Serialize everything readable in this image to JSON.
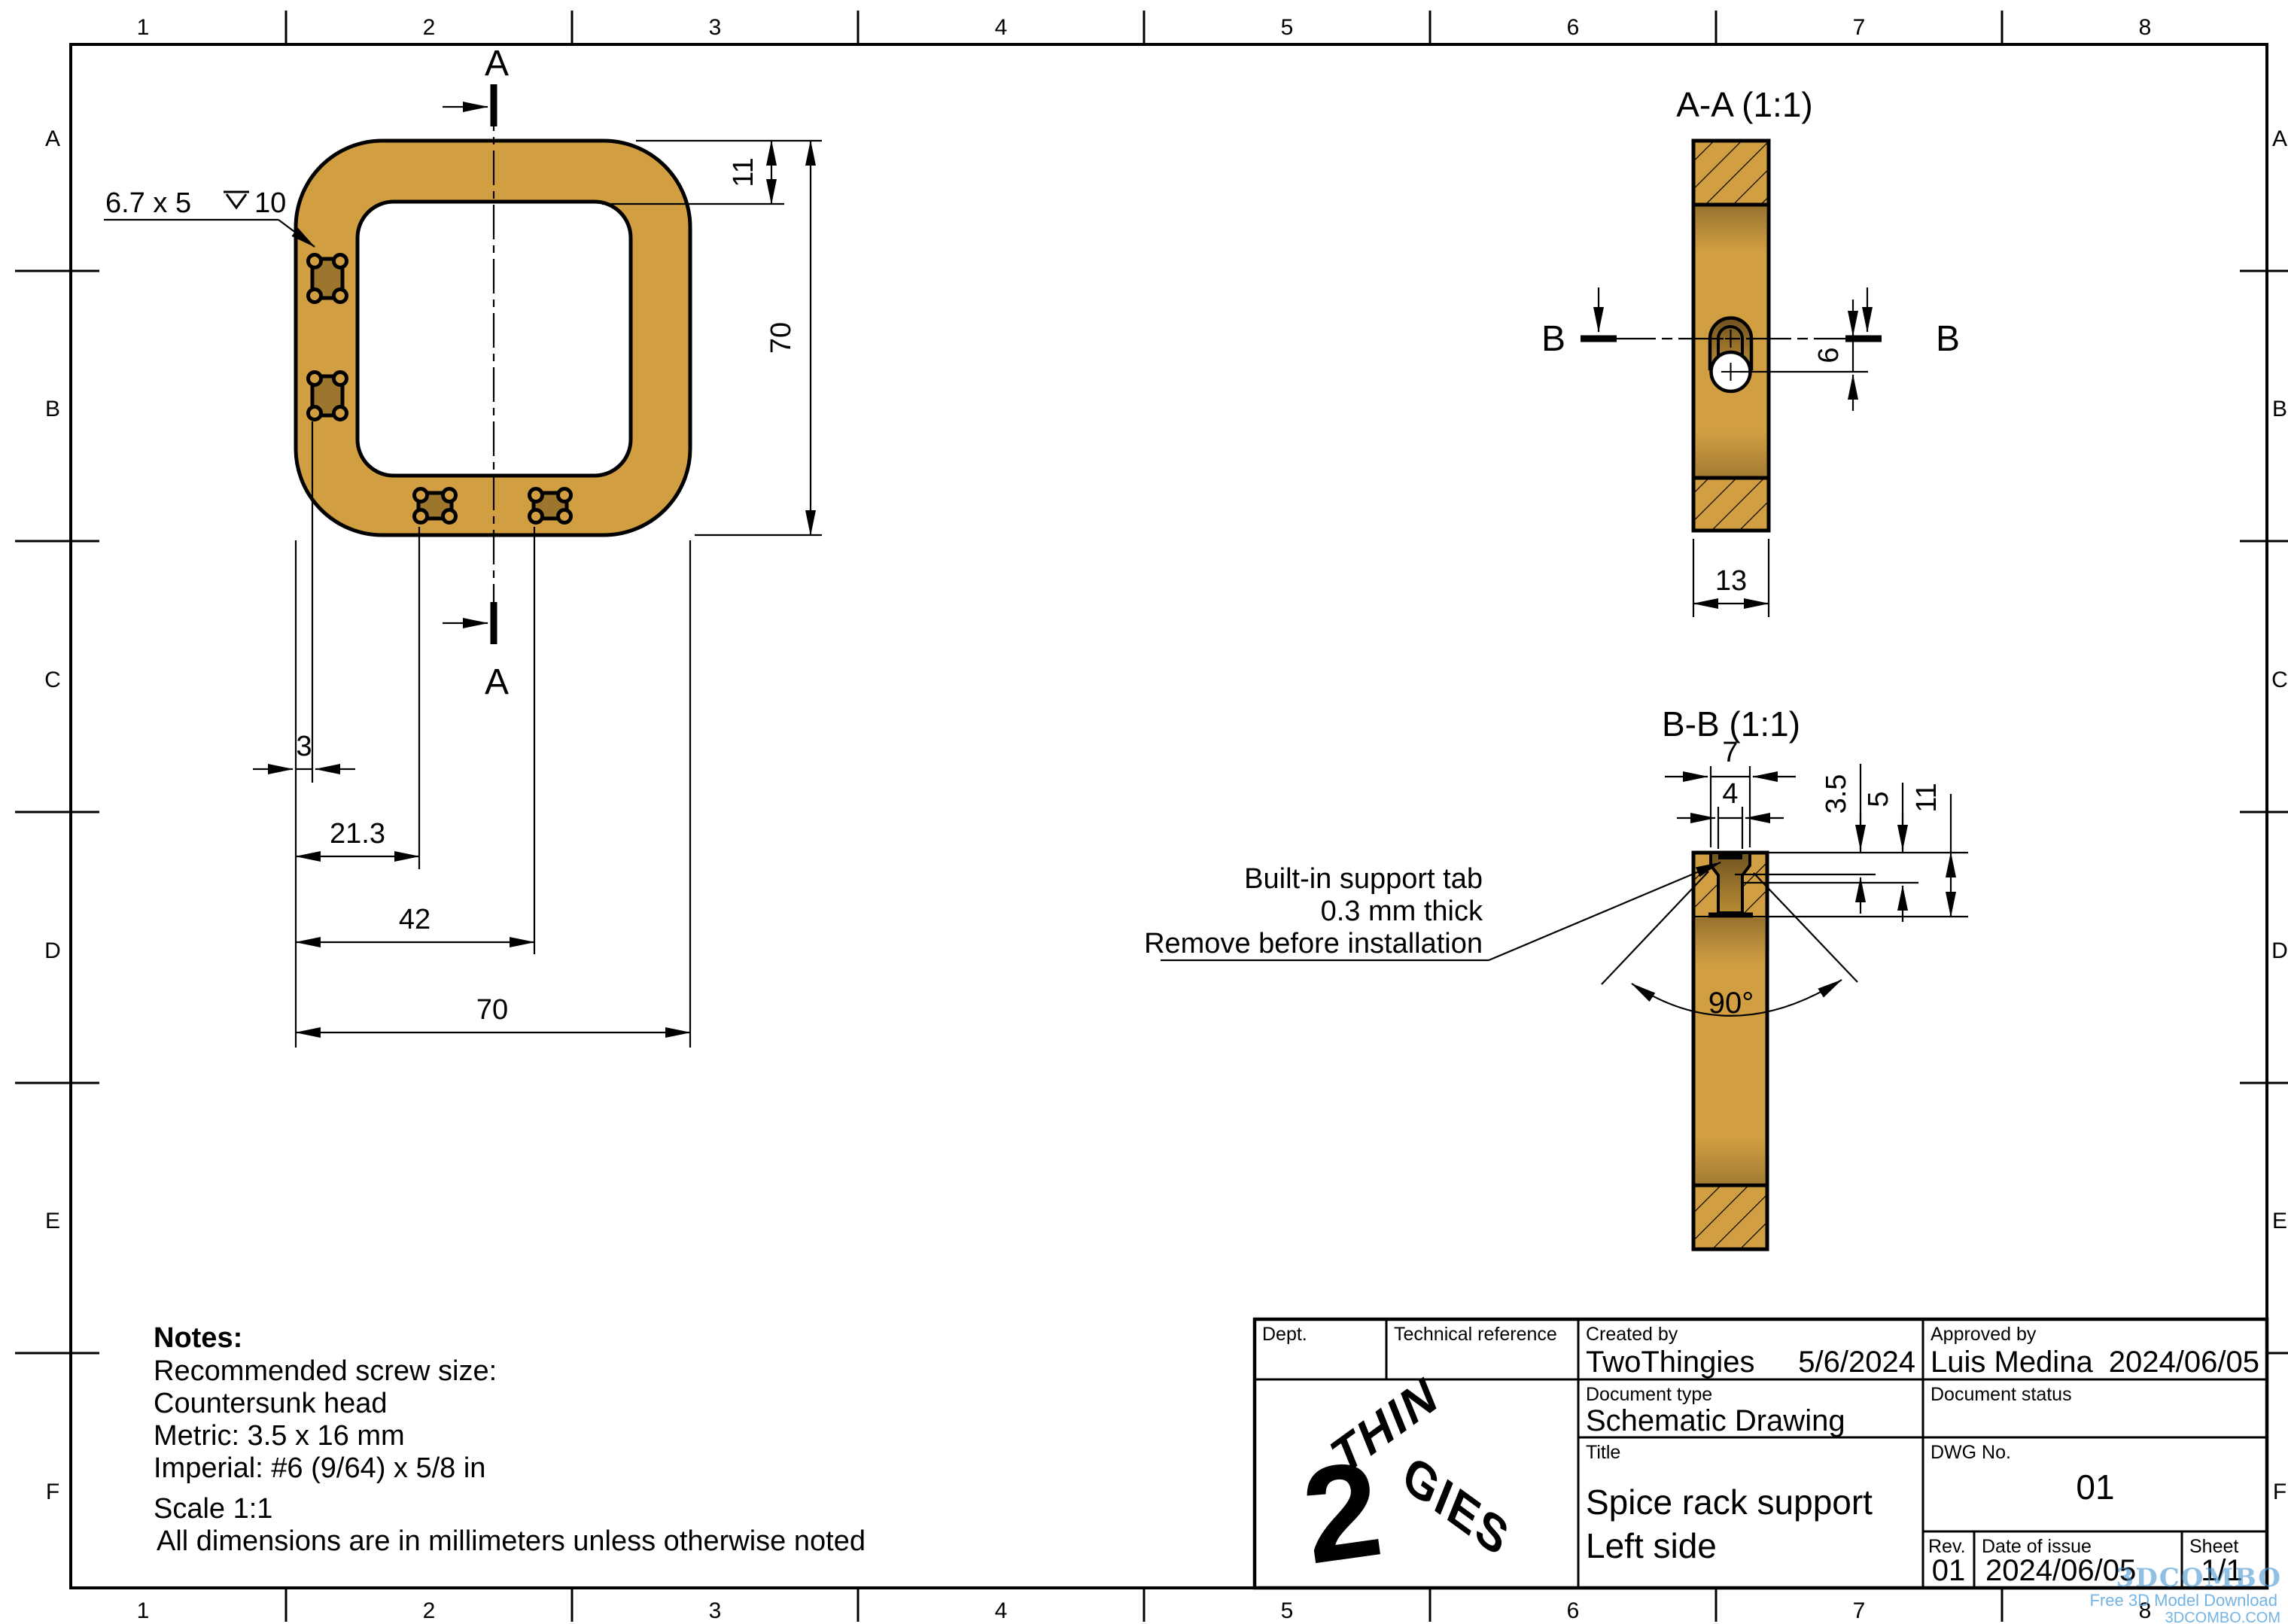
{
  "colors": {
    "part": "#d19f42",
    "hole_dark": "#9c762c",
    "recess_dark": "#8d6a29",
    "logo_teal": "#3be4cd",
    "watermark_blue": "#4d9ad5"
  },
  "border": {
    "cols": [
      "1",
      "2",
      "3",
      "4",
      "5",
      "6",
      "7",
      "8"
    ],
    "rows": [
      "A",
      "B",
      "C",
      "D",
      "E",
      "F"
    ]
  },
  "main_view": {
    "section_letter": "A",
    "callout_size": "6.7 x 5",
    "callout_depth": "10",
    "dim_top_wall": "11",
    "dim_height": "70",
    "dim_edge": "3",
    "dim_hole1": "21.3",
    "dim_hole2": "42",
    "dim_width": "70"
  },
  "section_aa": {
    "title": "A-A (1:1)",
    "cut_letter": "B",
    "dim_center_offset": "6",
    "dim_thickness": "13"
  },
  "section_bb": {
    "title": "B-B (1:1)",
    "dim_mouth": "7",
    "dim_slot": "4",
    "dim_cbore_depth": "3.5",
    "dim_taper_depth": "5",
    "dim_total_depth": "11",
    "dim_angle": "90°",
    "callout_line1": "Built-in support tab",
    "callout_line2": "0.3 mm thick",
    "callout_line3": "Remove before installation"
  },
  "notes": {
    "heading": "Notes:",
    "line1": "Recommended screw size:",
    "line2": "Countersunk head",
    "line3": "Metric: 3.5 x 16 mm",
    "line4": "Imperial: #6 (9/64) x 5/8 in",
    "line5": "Scale 1:1",
    "line6": "All dimensions are in millimeters unless otherwise noted"
  },
  "title_block": {
    "dept_label": "Dept.",
    "tech_ref_label": "Technical reference",
    "created_label": "Created by",
    "created_value": "TwoThingies",
    "created_date": "5/6/2024",
    "approved_label": "Approved by",
    "approved_value": "Luis Medina",
    "approved_date": "2024/06/05",
    "doc_type_label": "Document type",
    "doc_type_value": "Schematic Drawing",
    "doc_status_label": "Document status",
    "title_label": "Title",
    "title_line1": "Spice rack support",
    "title_line2": "Left side",
    "dwg_label": "DWG No.",
    "dwg_value": "01",
    "rev_label": "Rev.",
    "rev_value": "01",
    "date_label": "Date of issue",
    "date_value": "2024/06/05",
    "sheet_label": "Sheet",
    "sheet_value": "1/1"
  },
  "logo": {
    "digit": "2",
    "word_top": "THIN",
    "word_bottom": "GIES"
  },
  "watermark": {
    "brand": "3DCOMBO",
    "tagline": "Free 3D Model Download",
    "domain": "3DCOMBO.COM"
  }
}
